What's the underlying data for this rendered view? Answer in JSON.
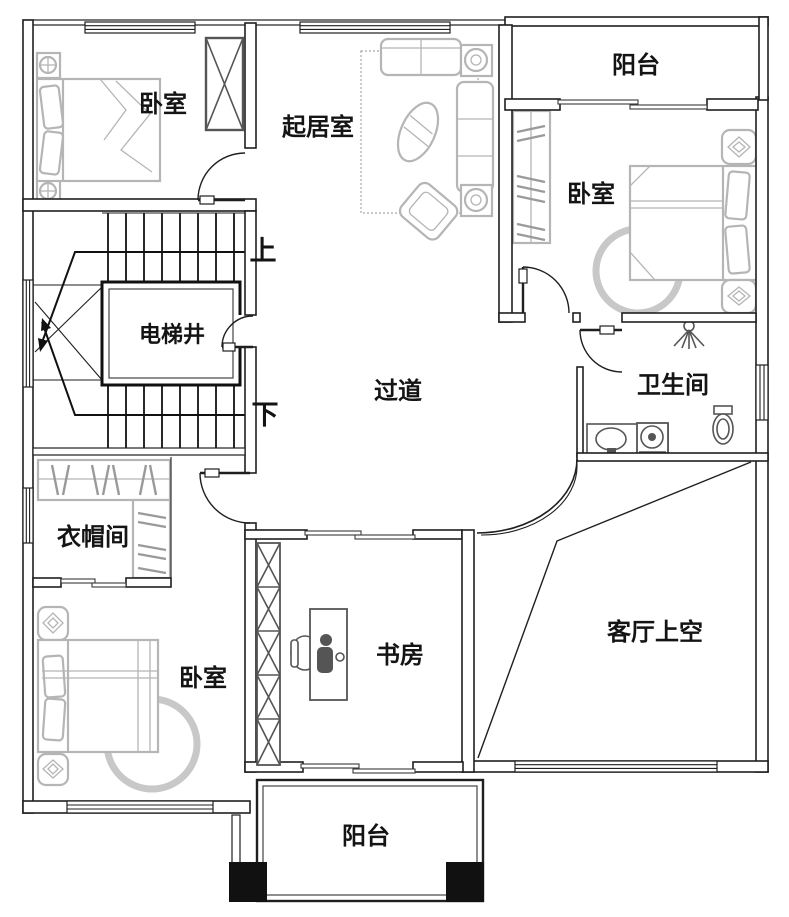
{
  "figure": {
    "type": "floor-plan",
    "language": "zh-CN"
  },
  "colors": {
    "wall": "#1f1f1f",
    "furniture_light": "#b5b5b5",
    "fixture": "#555555",
    "column_fill": "#111111",
    "background": "#ffffff"
  },
  "rooms": [
    {
      "id": "bedroom-top-left",
      "label": "卧室"
    },
    {
      "id": "living-room",
      "label": "起居室"
    },
    {
      "id": "balcony-top",
      "label": "阳台"
    },
    {
      "id": "bedroom-right",
      "label": "卧室"
    },
    {
      "id": "elevator-shaft",
      "label": "电梯井"
    },
    {
      "id": "hallway",
      "label": "过道"
    },
    {
      "id": "bathroom",
      "label": "卫生间"
    },
    {
      "id": "cloakroom",
      "label": "衣帽间"
    },
    {
      "id": "bedroom-bottom-left",
      "label": "卧室"
    },
    {
      "id": "study",
      "label": "书房"
    },
    {
      "id": "living-room-void",
      "label": "客厅上空"
    },
    {
      "id": "balcony-bottom",
      "label": "阳台"
    }
  ],
  "stairs": {
    "up_label": "上",
    "down_label": "下"
  },
  "furniture_icons": [
    "double-bed",
    "pillow",
    "nightstand",
    "wardrobe",
    "clothes-rack",
    "sofa-set",
    "coffee-table",
    "area-rug",
    "round-rug",
    "armchair",
    "desk",
    "office-chair",
    "bookshelf",
    "washbasin-counter",
    "washing-machine",
    "toilet",
    "shower-head"
  ]
}
